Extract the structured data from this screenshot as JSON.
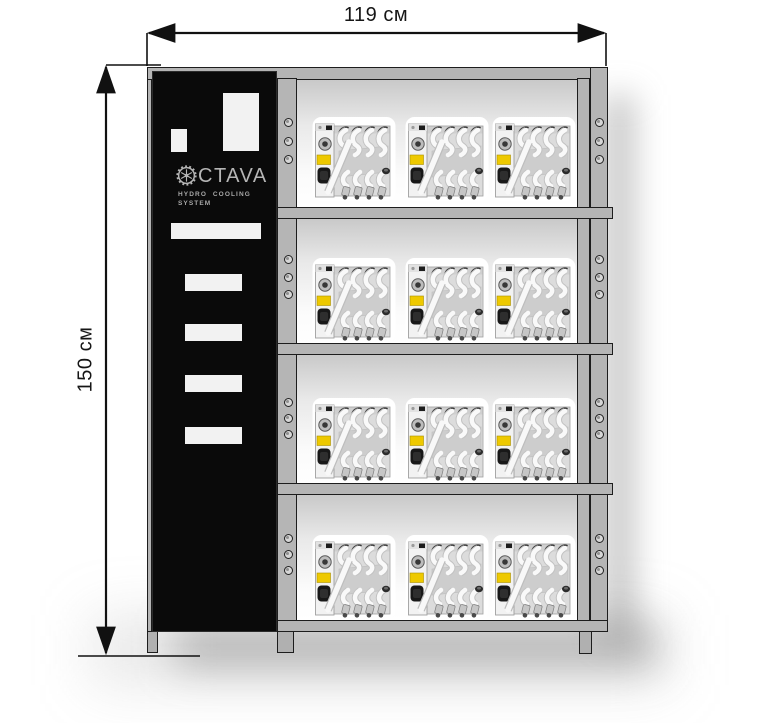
{
  "dimensions": {
    "width": {
      "label": "119 см"
    },
    "height": {
      "label": "150 см"
    }
  },
  "cabinet": {
    "brand_panel": {
      "logo_text": "CTAVA",
      "logo_icon": "gear",
      "subtitle_line1": "HYDRO COOLING",
      "subtitle_line2": "SYSTEM"
    },
    "shelving": {
      "rows": 4,
      "units_per_row": 3,
      "mounting_hole_groups": 4,
      "holes_per_group": 3
    }
  },
  "colors": {
    "frame_gray": "#b5b5b5",
    "frame_outline": "#1d1d1d",
    "panel_black": "#0a0a0a",
    "logo_gray": "#b5b5b5",
    "unit_label_yellow": "#eec900",
    "dimension_text": "#161616"
  }
}
